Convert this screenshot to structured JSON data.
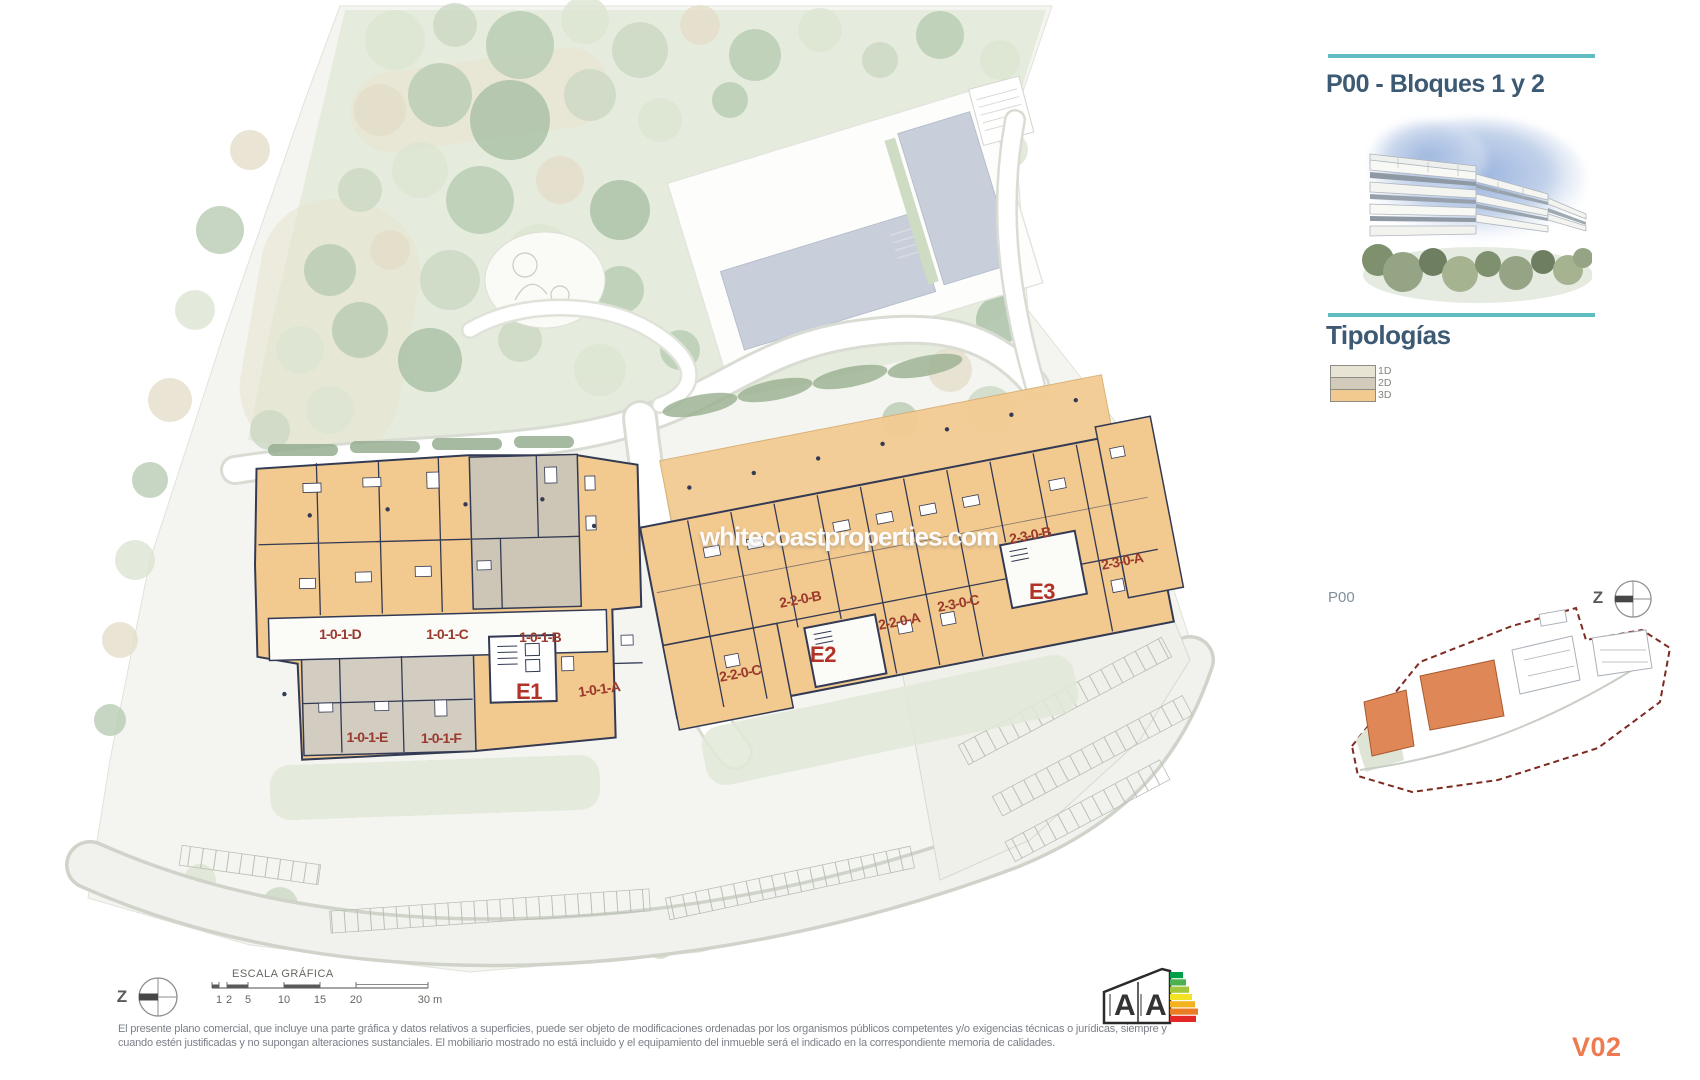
{
  "sidebar": {
    "title": "P00 - Bloques 1 y 2",
    "typologies_heading": "Tipologías",
    "legend": [
      {
        "label": "1D",
        "color": "#e8e4d4"
      },
      {
        "label": "2D",
        "color": "#d2cbbb"
      },
      {
        "label": "3D",
        "color": "#f2c98e"
      }
    ],
    "accent_line_color": "#5fbdbf"
  },
  "minimap": {
    "label": "P00",
    "compass_label": "Z",
    "boundary_color": "#7d2b20",
    "highlight_color": "#df8757"
  },
  "plan": {
    "watermark": "whitecoastproperties.com",
    "compass_label": "Z",
    "colors": {
      "typology_3d": "#f2c98e",
      "typology_2d": "#cdc5b5",
      "typology_1d": "#e8e4d4",
      "walls": "#333a54",
      "unit_label": "#9b392d",
      "block_label": "#b33226"
    },
    "blocks": [
      {
        "name": "E1",
        "units": [
          "1-0-1-D",
          "1-0-1-C",
          "1-0-1-B",
          "1-0-1-A",
          "1-0-1-E",
          "1-0-1-F"
        ]
      },
      {
        "name": "E2",
        "units": [
          "2-2-0-B",
          "2-2-0-A",
          "2-2-0-C"
        ]
      },
      {
        "name": "E3",
        "units": [
          "2-3-0-C",
          "2-3-0-B",
          "2-3-0-A"
        ]
      }
    ]
  },
  "scale_bar": {
    "title": "ESCALA GRÁFICA",
    "ticks": [
      "1",
      "2",
      "5",
      "10",
      "15",
      "20",
      "30 m"
    ]
  },
  "footer": {
    "disclaimer_line1": "El presente plano comercial, que incluye una parte gráfica y datos relativos a superficies, puede ser objeto de modificaciones ordenadas por los organismos públicos competentes y/o exigencias técnicas o jurídicas, siempre y",
    "disclaimer_line2": "cuando estén justificadas y no supongan alteraciones sustanciales. El mobiliario mostrado no está incluido y el equipamiento del inmueble será el indicado en la correspondiente memoria de calidades.",
    "version": "V02",
    "energy_rating_letters": [
      "A",
      "A"
    ]
  }
}
